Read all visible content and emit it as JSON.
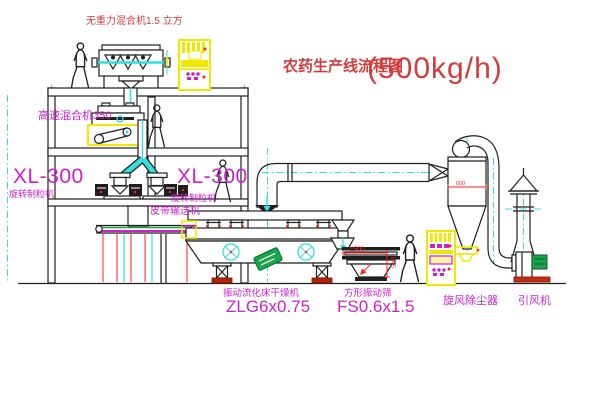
{
  "title": {
    "name": "农药生产线流程图",
    "capacity": "(500kg/h)"
  },
  "equipment": {
    "gravity_mixer": {
      "label": "无重力混合机1.5 立方"
    },
    "high_speed_mixer": {
      "label": "高速混合机350"
    },
    "granulator_left": {
      "model": "XL-300",
      "name": "旋转制粒机"
    },
    "granulator_right": {
      "model": "XL-300",
      "name": "旋转制粒机"
    },
    "belt_conveyor": {
      "label": "皮带输送机"
    },
    "fluid_bed_dryer": {
      "name": "振动流化床干燥机",
      "model": "ZLG6x0.75"
    },
    "vibrating_screen": {
      "name": "方形振动筛",
      "model": "FS0.6x1.5"
    },
    "cyclone": {
      "name": "旋风除尘器"
    },
    "fan": {
      "name": "引风机"
    }
  },
  "dimensions": {
    "screen_length": "1500",
    "screen_height": "945",
    "cyclone_dia": "600"
  },
  "colors": {
    "line": "#1f1f1f",
    "centerline_cyan": "#35dede",
    "label_magenta": "#cc22cc",
    "title_red": "#d23c3c",
    "dimension_red": "#ff2020",
    "cabinet_yellow": "#f0e800",
    "motor_green": "#18a54a"
  }
}
